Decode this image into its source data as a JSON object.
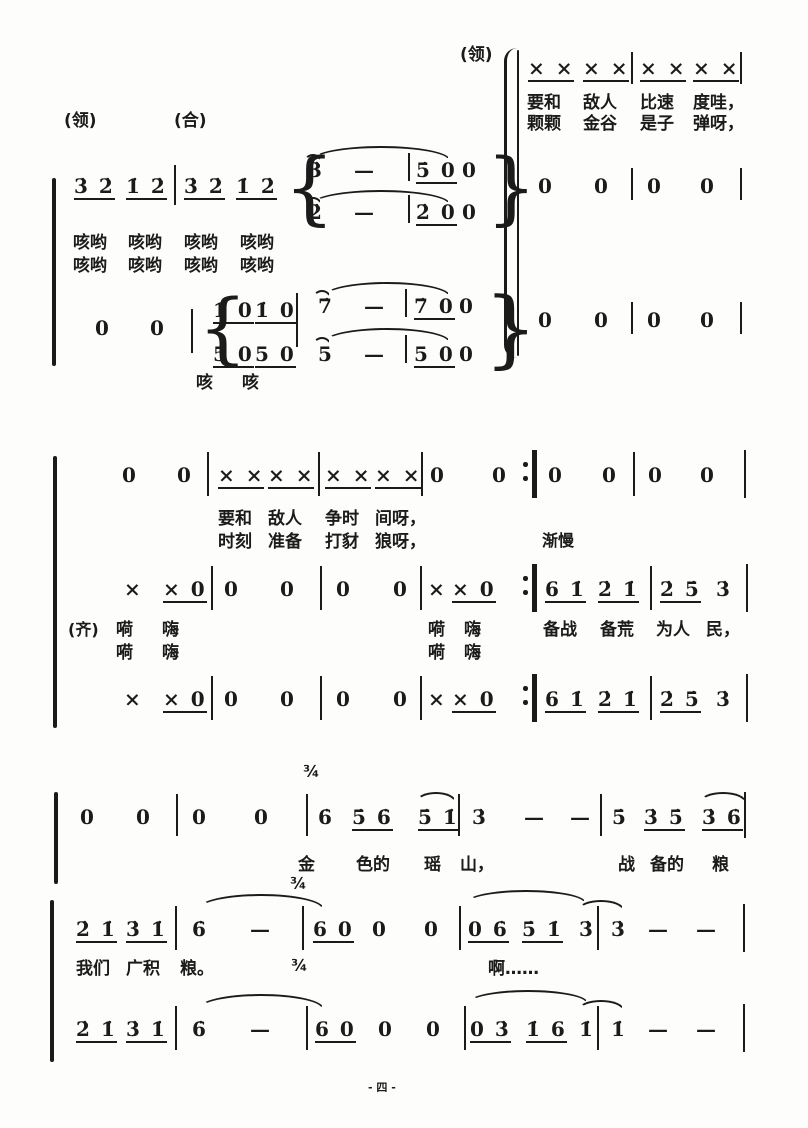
{
  "style": {
    "ink": "#1b1b1b",
    "paper": "#fdfdfb"
  },
  "footer": {
    "page_marker": "- 四 -"
  },
  "score": {
    "labels": [
      {
        "t": "(领)",
        "x": 460,
        "y": 46,
        "fs": 17
      },
      {
        "t": "(领)",
        "x": 64,
        "y": 112,
        "fs": 17
      },
      {
        "t": "(合)",
        "x": 174,
        "y": 112,
        "fs": 17
      },
      {
        "t": "(齐)",
        "x": 68,
        "y": 620,
        "fs": 16
      },
      {
        "t": "渐慢",
        "x": 542,
        "y": 531,
        "fs": 16
      },
      {
        "t": "¾",
        "x": 303,
        "y": 762,
        "fs": 16
      },
      {
        "t": "¾",
        "x": 290,
        "y": 874,
        "fs": 16
      },
      {
        "t": "¾",
        "x": 291,
        "y": 956,
        "fs": 16
      },
      {
        "t": "- 四 -",
        "x": 368,
        "y": 1078,
        "fs": 11
      }
    ],
    "note_tokens": [
      {
        "t": "× ×",
        "x": 528,
        "y": 57,
        "u": 1
      },
      {
        "t": "× ×",
        "x": 583,
        "y": 57,
        "u": 1
      },
      {
        "t": "× ×",
        "x": 640,
        "y": 57,
        "u": 1
      },
      {
        "t": "× ×",
        "x": 693,
        "y": 57,
        "u": 1
      },
      {
        "t": "0",
        "x": 538,
        "y": 175
      },
      {
        "t": "0",
        "x": 594,
        "y": 175
      },
      {
        "t": "0",
        "x": 647,
        "y": 175
      },
      {
        "t": "0",
        "x": 700,
        "y": 175
      },
      {
        "t": "0",
        "x": 538,
        "y": 309
      },
      {
        "t": "0",
        "x": 594,
        "y": 309
      },
      {
        "t": "0",
        "x": 647,
        "y": 309
      },
      {
        "t": "0",
        "x": 700,
        "y": 309
      },
      {
        "t": "3̇ 2̇",
        "x": 74,
        "y": 175,
        "u": 1
      },
      {
        "t": "1̇ 2̇",
        "x": 126,
        "y": 175,
        "u": 1
      },
      {
        "t": "3̇ 2̇",
        "x": 184,
        "y": 175,
        "u": 1
      },
      {
        "t": "1̇ 2̇",
        "x": 236,
        "y": 175,
        "u": 1
      },
      {
        "t": "3̇",
        "x": 308,
        "y": 159
      },
      {
        "t": "—",
        "x": 354,
        "y": 159
      },
      {
        "t": "5̇ 0",
        "x": 416,
        "y": 159,
        "u": 1
      },
      {
        "t": "0",
        "x": 462,
        "y": 159
      },
      {
        "t": "2̇",
        "x": 308,
        "y": 201
      },
      {
        "t": "—",
        "x": 354,
        "y": 201
      },
      {
        "t": "2̇ 0",
        "x": 416,
        "y": 201,
        "u": 1
      },
      {
        "t": "0",
        "x": 462,
        "y": 201
      },
      {
        "t": "0",
        "x": 95,
        "y": 317
      },
      {
        "t": "0",
        "x": 150,
        "y": 317
      },
      {
        "t": "1̇ 0",
        "x": 213,
        "y": 299,
        "u": 1
      },
      {
        "t": "1̇ 0",
        "x": 255,
        "y": 299,
        "u": 1
      },
      {
        "t": "7̇",
        "x": 318,
        "y": 295
      },
      {
        "t": "—",
        "x": 364,
        "y": 295
      },
      {
        "t": "7̇ 0",
        "x": 414,
        "y": 295,
        "u": 1
      },
      {
        "t": "0",
        "x": 459,
        "y": 295
      },
      {
        "t": "5 0",
        "x": 213,
        "y": 343,
        "u": 1
      },
      {
        "t": "5 0",
        "x": 255,
        "y": 343,
        "u": 1
      },
      {
        "t": "5",
        "x": 318,
        "y": 343
      },
      {
        "t": "—",
        "x": 364,
        "y": 343
      },
      {
        "t": "5 0",
        "x": 414,
        "y": 343,
        "u": 1
      },
      {
        "t": "0",
        "x": 459,
        "y": 343
      },
      {
        "t": "0",
        "x": 122,
        "y": 464
      },
      {
        "t": "0",
        "x": 177,
        "y": 464
      },
      {
        "t": "× ×",
        "x": 218,
        "y": 464,
        "u": 1
      },
      {
        "t": "× ×",
        "x": 268,
        "y": 464,
        "u": 1
      },
      {
        "t": "× ×",
        "x": 325,
        "y": 464,
        "u": 1
      },
      {
        "t": "× ×",
        "x": 375,
        "y": 464,
        "u": 1
      },
      {
        "t": "0",
        "x": 430,
        "y": 464
      },
      {
        "t": "0",
        "x": 492,
        "y": 464
      },
      {
        "t": "0",
        "x": 548,
        "y": 464
      },
      {
        "t": "0",
        "x": 602,
        "y": 464
      },
      {
        "t": "0",
        "x": 648,
        "y": 464
      },
      {
        "t": "0",
        "x": 700,
        "y": 464
      },
      {
        "t": "×",
        "x": 124,
        "y": 578
      },
      {
        "t": "× 0",
        "x": 163,
        "y": 578,
        "u": 1
      },
      {
        "t": "0",
        "x": 224,
        "y": 578
      },
      {
        "t": "0",
        "x": 280,
        "y": 578
      },
      {
        "t": "0",
        "x": 336,
        "y": 578
      },
      {
        "t": "0",
        "x": 393,
        "y": 578
      },
      {
        "t": "×",
        "x": 428,
        "y": 578
      },
      {
        "t": "× 0",
        "x": 452,
        "y": 578,
        "u": 1
      },
      {
        "t": "6 1̇",
        "x": 545,
        "y": 578,
        "u": 1
      },
      {
        "t": "2̇ 1̇",
        "x": 598,
        "y": 578,
        "u": 1
      },
      {
        "t": "2̇ 5̇",
        "x": 660,
        "y": 578,
        "u": 1
      },
      {
        "t": "3̇",
        "x": 716,
        "y": 578
      },
      {
        "t": "×",
        "x": 124,
        "y": 688
      },
      {
        "t": "× 0",
        "x": 163,
        "y": 688,
        "u": 1
      },
      {
        "t": "0",
        "x": 224,
        "y": 688
      },
      {
        "t": "0",
        "x": 280,
        "y": 688
      },
      {
        "t": "0",
        "x": 336,
        "y": 688
      },
      {
        "t": "0",
        "x": 393,
        "y": 688
      },
      {
        "t": "×",
        "x": 428,
        "y": 688
      },
      {
        "t": "× 0",
        "x": 452,
        "y": 688,
        "u": 1
      },
      {
        "t": "6 1̇",
        "x": 545,
        "y": 688,
        "u": 1
      },
      {
        "t": "2̇ 1̇",
        "x": 598,
        "y": 688,
        "u": 1
      },
      {
        "t": "2̇ 5̇",
        "x": 660,
        "y": 688,
        "u": 1
      },
      {
        "t": "3̇",
        "x": 716,
        "y": 688
      },
      {
        "t": "0",
        "x": 80,
        "y": 806
      },
      {
        "t": "0",
        "x": 136,
        "y": 806
      },
      {
        "t": "0",
        "x": 192,
        "y": 806
      },
      {
        "t": "0",
        "x": 254,
        "y": 806
      },
      {
        "t": "6̇",
        "x": 318,
        "y": 806
      },
      {
        "t": "5̇ 6̇",
        "x": 352,
        "y": 806,
        "u": 1
      },
      {
        "t": "5̇ 1̇",
        "x": 418,
        "y": 806,
        "u": 1
      },
      {
        "t": "3̇",
        "x": 472,
        "y": 806
      },
      {
        "t": "—",
        "x": 524,
        "y": 806
      },
      {
        "t": "—",
        "x": 570,
        "y": 806
      },
      {
        "t": "5̇",
        "x": 612,
        "y": 806
      },
      {
        "t": "3̇ 5̇",
        "x": 644,
        "y": 806,
        "u": 1
      },
      {
        "t": "3̇ 6̇",
        "x": 702,
        "y": 806,
        "u": 1
      },
      {
        "t": "2̇ 1̇",
        "x": 76,
        "y": 918,
        "u": 1
      },
      {
        "t": "3̇ 1̇",
        "x": 126,
        "y": 918,
        "u": 1
      },
      {
        "t": "6̇",
        "x": 192,
        "y": 918
      },
      {
        "t": "—",
        "x": 250,
        "y": 918
      },
      {
        "t": "6 0",
        "x": 313,
        "y": 918,
        "u": 1
      },
      {
        "t": "0",
        "x": 372,
        "y": 918
      },
      {
        "t": "0",
        "x": 424,
        "y": 918
      },
      {
        "t": "0 6̇",
        "x": 468,
        "y": 918,
        "u": 1
      },
      {
        "t": "5̇ 1̇",
        "x": 522,
        "y": 918,
        "u": 1
      },
      {
        "t": "3̇",
        "x": 579,
        "y": 918
      },
      {
        "t": "3̇",
        "x": 611,
        "y": 918
      },
      {
        "t": "—",
        "x": 648,
        "y": 918
      },
      {
        "t": "—",
        "x": 696,
        "y": 918
      },
      {
        "t": "2̇ 1̇",
        "x": 76,
        "y": 1018,
        "u": 1
      },
      {
        "t": "3̇ 1̇",
        "x": 126,
        "y": 1018,
        "u": 1
      },
      {
        "t": "6̇",
        "x": 192,
        "y": 1018
      },
      {
        "t": "—",
        "x": 250,
        "y": 1018
      },
      {
        "t": "6 0",
        "x": 315,
        "y": 1018,
        "u": 1
      },
      {
        "t": "0",
        "x": 378,
        "y": 1018
      },
      {
        "t": "0",
        "x": 426,
        "y": 1018
      },
      {
        "t": "0 3̇",
        "x": 470,
        "y": 1018,
        "u": 1
      },
      {
        "t": "1̇ 6",
        "x": 526,
        "y": 1018,
        "u": 1
      },
      {
        "t": "1̇",
        "x": 579,
        "y": 1018
      },
      {
        "t": "1̇",
        "x": 611,
        "y": 1018
      },
      {
        "t": "—",
        "x": 648,
        "y": 1018
      },
      {
        "t": "—",
        "x": 696,
        "y": 1018
      }
    ],
    "lyric_tokens": [
      {
        "t": "要和",
        "x": 527,
        "y": 94
      },
      {
        "t": "敌人",
        "x": 583,
        "y": 94
      },
      {
        "t": "比速",
        "x": 640,
        "y": 94
      },
      {
        "t": "度哇，",
        "x": 693,
        "y": 94
      },
      {
        "t": "颗颗",
        "x": 527,
        "y": 115
      },
      {
        "t": "金谷",
        "x": 583,
        "y": 115
      },
      {
        "t": "是子",
        "x": 640,
        "y": 115
      },
      {
        "t": "弹呀，",
        "x": 693,
        "y": 115
      },
      {
        "t": "咳哟",
        "x": 73,
        "y": 234
      },
      {
        "t": "咳哟",
        "x": 128,
        "y": 234
      },
      {
        "t": "咳哟",
        "x": 184,
        "y": 234
      },
      {
        "t": "咳哟",
        "x": 240,
        "y": 234
      },
      {
        "t": "咳哟",
        "x": 73,
        "y": 257
      },
      {
        "t": "咳哟",
        "x": 128,
        "y": 257
      },
      {
        "t": "咳哟",
        "x": 184,
        "y": 257
      },
      {
        "t": "咳哟",
        "x": 240,
        "y": 257
      },
      {
        "t": "咳",
        "x": 196,
        "y": 374
      },
      {
        "t": "咳",
        "x": 242,
        "y": 374
      },
      {
        "t": "要和",
        "x": 218,
        "y": 510
      },
      {
        "t": "敌人",
        "x": 268,
        "y": 510
      },
      {
        "t": "争时",
        "x": 325,
        "y": 510
      },
      {
        "t": "间呀，",
        "x": 375,
        "y": 510
      },
      {
        "t": "时刻",
        "x": 218,
        "y": 533
      },
      {
        "t": "准备",
        "x": 268,
        "y": 533
      },
      {
        "t": "打豺",
        "x": 325,
        "y": 533
      },
      {
        "t": "狼呀，",
        "x": 375,
        "y": 533
      },
      {
        "t": "嗬",
        "x": 116,
        "y": 621
      },
      {
        "t": "嗨",
        "x": 162,
        "y": 621
      },
      {
        "t": "嗬",
        "x": 116,
        "y": 644
      },
      {
        "t": "嗨",
        "x": 162,
        "y": 644
      },
      {
        "t": "嗬",
        "x": 428,
        "y": 621
      },
      {
        "t": "嗨",
        "x": 464,
        "y": 621
      },
      {
        "t": "嗬",
        "x": 428,
        "y": 644
      },
      {
        "t": "嗨",
        "x": 464,
        "y": 644
      },
      {
        "t": "备战",
        "x": 543,
        "y": 621
      },
      {
        "t": "备荒",
        "x": 600,
        "y": 621
      },
      {
        "t": "为人",
        "x": 656,
        "y": 621
      },
      {
        "t": "民，",
        "x": 706,
        "y": 621
      },
      {
        "t": "金",
        "x": 298,
        "y": 856
      },
      {
        "t": "色的",
        "x": 356,
        "y": 856
      },
      {
        "t": "瑶",
        "x": 424,
        "y": 856
      },
      {
        "t": "山，",
        "x": 460,
        "y": 856
      },
      {
        "t": "战",
        "x": 618,
        "y": 856
      },
      {
        "t": "备的",
        "x": 650,
        "y": 856
      },
      {
        "t": "粮",
        "x": 712,
        "y": 856
      },
      {
        "t": "我们",
        "x": 76,
        "y": 960
      },
      {
        "t": "广积",
        "x": 126,
        "y": 960
      },
      {
        "t": "粮。",
        "x": 180,
        "y": 960
      },
      {
        "t": "啊……",
        "x": 488,
        "y": 960
      }
    ],
    "bars": [
      {
        "x": 631,
        "y": 52,
        "h": 32
      },
      {
        "x": 740,
        "y": 52,
        "h": 32
      },
      {
        "x": 631,
        "y": 168,
        "h": 32
      },
      {
        "x": 740,
        "y": 168,
        "h": 32
      },
      {
        "x": 631,
        "y": 302,
        "h": 32
      },
      {
        "x": 740,
        "y": 302,
        "h": 32
      },
      {
        "x": 174,
        "y": 165,
        "h": 40
      },
      {
        "x": 408,
        "y": 153,
        "h": 28
      },
      {
        "x": 408,
        "y": 195,
        "h": 28
      },
      {
        "x": 191,
        "y": 309,
        "h": 44
      },
      {
        "x": 296,
        "y": 293,
        "h": 54
      },
      {
        "x": 405,
        "y": 289,
        "h": 28
      },
      {
        "x": 405,
        "y": 335,
        "h": 28
      },
      {
        "x": 207,
        "y": 452,
        "h": 44
      },
      {
        "x": 318,
        "y": 452,
        "h": 44
      },
      {
        "x": 421,
        "y": 452,
        "h": 44
      },
      {
        "x": 532,
        "y": 450,
        "h": 48,
        "w": 5
      },
      {
        "x": 633,
        "y": 452,
        "h": 44
      },
      {
        "x": 744,
        "y": 450,
        "h": 48
      },
      {
        "x": 211,
        "y": 566,
        "h": 44
      },
      {
        "x": 320,
        "y": 566,
        "h": 44
      },
      {
        "x": 420,
        "y": 566,
        "h": 44
      },
      {
        "x": 532,
        "y": 564,
        "h": 48,
        "w": 5
      },
      {
        "x": 650,
        "y": 566,
        "h": 44
      },
      {
        "x": 746,
        "y": 564,
        "h": 48
      },
      {
        "x": 211,
        "y": 676,
        "h": 44
      },
      {
        "x": 320,
        "y": 676,
        "h": 44
      },
      {
        "x": 420,
        "y": 676,
        "h": 44
      },
      {
        "x": 532,
        "y": 674,
        "h": 48,
        "w": 5
      },
      {
        "x": 650,
        "y": 676,
        "h": 44
      },
      {
        "x": 746,
        "y": 674,
        "h": 48
      },
      {
        "x": 176,
        "y": 794,
        "h": 42
      },
      {
        "x": 306,
        "y": 794,
        "h": 42
      },
      {
        "x": 458,
        "y": 794,
        "h": 42
      },
      {
        "x": 600,
        "y": 794,
        "h": 42
      },
      {
        "x": 744,
        "y": 792,
        "h": 46
      },
      {
        "x": 175,
        "y": 906,
        "h": 44
      },
      {
        "x": 302,
        "y": 906,
        "h": 44
      },
      {
        "x": 459,
        "y": 906,
        "h": 44
      },
      {
        "x": 597,
        "y": 906,
        "h": 44
      },
      {
        "x": 743,
        "y": 904,
        "h": 48
      },
      {
        "x": 175,
        "y": 1006,
        "h": 44
      },
      {
        "x": 306,
        "y": 1006,
        "h": 44
      },
      {
        "x": 464,
        "y": 1006,
        "h": 44
      },
      {
        "x": 597,
        "y": 1006,
        "h": 44
      },
      {
        "x": 743,
        "y": 1004,
        "h": 48
      }
    ],
    "repeat_dots": [
      {
        "x": 523,
        "y": 462
      },
      {
        "x": 523,
        "y": 476
      },
      {
        "x": 523,
        "y": 576
      },
      {
        "x": 523,
        "y": 590
      },
      {
        "x": 523,
        "y": 686
      },
      {
        "x": 523,
        "y": 700
      }
    ],
    "arcs": [
      {
        "x": 312,
        "y": 146,
        "w": 138,
        "h": 14
      },
      {
        "x": 304,
        "y": 154,
        "w": 18,
        "h": 8
      },
      {
        "x": 312,
        "y": 190,
        "w": 138,
        "h": 14
      },
      {
        "x": 304,
        "y": 197,
        "w": 18,
        "h": 8
      },
      {
        "x": 324,
        "y": 282,
        "w": 126,
        "h": 14
      },
      {
        "x": 313,
        "y": 290,
        "w": 18,
        "h": 8
      },
      {
        "x": 324,
        "y": 328,
        "w": 126,
        "h": 14
      },
      {
        "x": 313,
        "y": 337,
        "w": 18,
        "h": 8
      },
      {
        "x": 416,
        "y": 792,
        "w": 40,
        "h": 10
      },
      {
        "x": 700,
        "y": 792,
        "w": 46,
        "h": 10
      },
      {
        "x": 198,
        "y": 894,
        "w": 126,
        "h": 15
      },
      {
        "x": 466,
        "y": 890,
        "w": 120,
        "h": 13
      },
      {
        "x": 578,
        "y": 900,
        "w": 46,
        "h": 10
      },
      {
        "x": 198,
        "y": 994,
        "w": 126,
        "h": 15
      },
      {
        "x": 468,
        "y": 990,
        "w": 120,
        "h": 13
      },
      {
        "x": 578,
        "y": 1000,
        "w": 46,
        "h": 10
      }
    ],
    "braces": [
      {
        "t": "{",
        "x": 284,
        "y": 150,
        "h": 76
      },
      {
        "t": "}",
        "x": 486,
        "y": 150,
        "h": 76
      },
      {
        "t": "{",
        "x": 198,
        "y": 292,
        "h": 74
      },
      {
        "t": "}",
        "x": 484,
        "y": 288,
        "h": 80
      },
      {
        "t": "paren",
        "x": 504,
        "y": 48,
        "h": 310
      }
    ],
    "rules": [
      {
        "x": 517,
        "y": 50,
        "w": 2.4,
        "h": 306
      },
      {
        "x": 52,
        "y": 178,
        "w": 3.5,
        "h": 188
      },
      {
        "x": 53,
        "y": 456,
        "w": 3.5,
        "h": 272
      },
      {
        "x": 54,
        "y": 792,
        "w": 3.5,
        "h": 92
      },
      {
        "x": 50,
        "y": 900,
        "w": 3.5,
        "h": 162
      }
    ]
  }
}
